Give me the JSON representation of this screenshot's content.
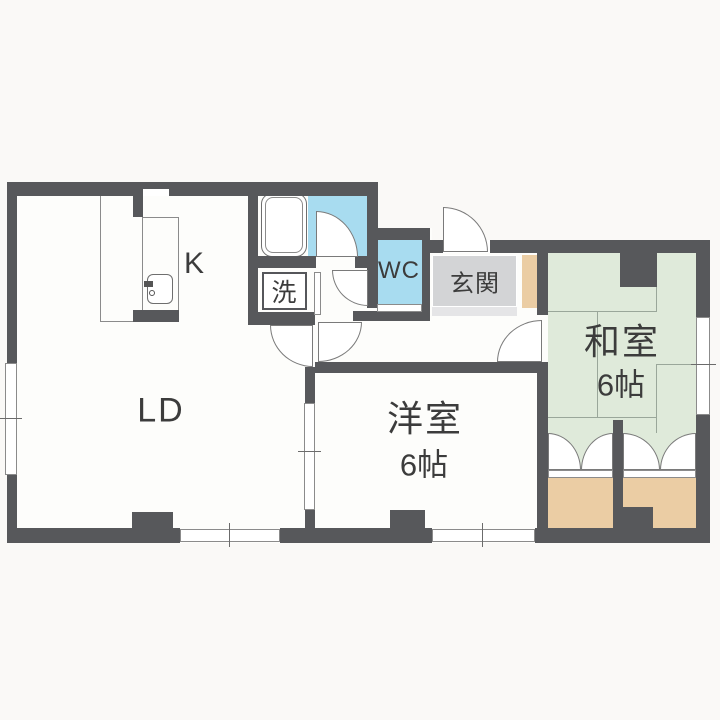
{
  "plan": {
    "type": "apartment-floor-plan",
    "rooms": {
      "living_dining": "LD",
      "kitchen": "K",
      "laundry": "洗",
      "toilet": "WC",
      "entrance": "玄関",
      "japanese_room": "和室",
      "japanese_room_size": "6帖",
      "western_room": "洋室",
      "western_room_size": "6帖"
    },
    "colors": {
      "wall": "#57585b",
      "water_blue": "#a8dcf0",
      "tatami_green": "#dfeada",
      "closet_tan": "#ebcda4",
      "entrance_gray": "#d3d4d6",
      "entrance_step": "#e5e5e7",
      "floor_white": "#fdfdfb",
      "background": "#faf9f7",
      "line_gray": "#8b8b8b",
      "text": "#3c3c3c"
    }
  }
}
